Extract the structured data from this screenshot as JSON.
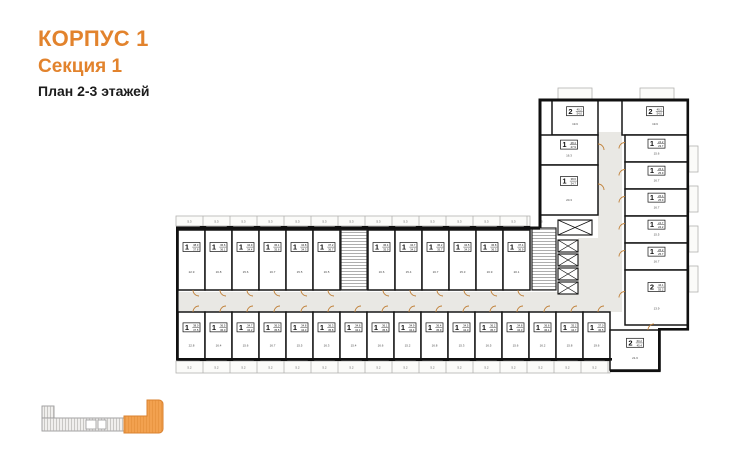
{
  "title": {
    "building": "КОРПУС 1",
    "section": "Секция 1",
    "floors": "План 2-3 этажей"
  },
  "colors": {
    "accent_orange": "#E2832D",
    "wall": "#101010",
    "corridor": "#E9E8E4",
    "door_arc": "#C08038",
    "balcony_outline": "#b3b2b0",
    "locator_fill": "#F2A14F",
    "locator_stroke": "#D9812F"
  },
  "plan": {
    "strips": [
      {
        "x": 176,
        "y": 216,
        "w": 354,
        "h": 10,
        "step": 27,
        "label": "5.3",
        "pier_y": 226
      },
      {
        "x": 176,
        "y": 361,
        "w": 434,
        "h": 12,
        "step": 27,
        "label": "5.2",
        "pier_y": 355
      }
    ],
    "units": [
      {
        "x": 178,
        "y": 230,
        "w": 27,
        "h": 60,
        "t": "1",
        "a1": "38.3",
        "a2": "37.8",
        "r": "22.9",
        "d": "b"
      },
      {
        "x": 205,
        "y": 230,
        "w": 27,
        "h": 60,
        "t": "1",
        "a1": "36.6",
        "a2": "36.1",
        "r": "16.8",
        "d": "b"
      },
      {
        "x": 232,
        "y": 230,
        "w": 27,
        "h": 60,
        "t": "1",
        "a1": "34.9",
        "a2": "34.4",
        "r": "15.6",
        "d": "b"
      },
      {
        "x": 259,
        "y": 230,
        "w": 27,
        "h": 60,
        "t": "1",
        "a1": "36.1",
        "a2": "35.6",
        "r": "16.7",
        "d": "b"
      },
      {
        "x": 286,
        "y": 230,
        "w": 27,
        "h": 60,
        "t": "1",
        "a1": "34.8",
        "a2": "34.3",
        "r": "15.5",
        "d": "b"
      },
      {
        "x": 313,
        "y": 230,
        "w": 27,
        "h": 60,
        "t": "1",
        "a1": "37.2",
        "a2": "36.7",
        "r": "16.5",
        "d": "b"
      },
      {
        "x": 368,
        "y": 230,
        "w": 27,
        "h": 60,
        "t": "1",
        "a1": "36.4",
        "a2": "35.9",
        "r": "16.6",
        "d": "b"
      },
      {
        "x": 395,
        "y": 230,
        "w": 27,
        "h": 60,
        "t": "1",
        "a1": "34.7",
        "a2": "34.2",
        "r": "15.4",
        "d": "b"
      },
      {
        "x": 422,
        "y": 230,
        "w": 27,
        "h": 60,
        "t": "1",
        "a1": "36.2",
        "a2": "35.7",
        "r": "16.7",
        "d": "b"
      },
      {
        "x": 449,
        "y": 230,
        "w": 27,
        "h": 60,
        "t": "1",
        "a1": "34.5",
        "a2": "34.0",
        "r": "15.3",
        "d": "b"
      },
      {
        "x": 476,
        "y": 230,
        "w": 27,
        "h": 60,
        "t": "1",
        "a1": "36.8",
        "a2": "36.3",
        "r": "16.9",
        "d": "b"
      },
      {
        "x": 503,
        "y": 230,
        "w": 27,
        "h": 60,
        "t": "1",
        "a1": "37.4",
        "a2": "36.9",
        "r": "20.1",
        "d": "b"
      },
      {
        "x": 178,
        "y": 312,
        "w": 27,
        "h": 48,
        "t": "1",
        "a1": "38.0",
        "a2": "37.5",
        "r": "22.8",
        "d": "t"
      },
      {
        "x": 205,
        "y": 312,
        "w": 27,
        "h": 48,
        "t": "1",
        "a1": "36.5",
        "a2": "36.0",
        "r": "16.4",
        "d": "t"
      },
      {
        "x": 232,
        "y": 312,
        "w": 27,
        "h": 48,
        "t": "1",
        "a1": "34.7",
        "a2": "34.2",
        "r": "15.6",
        "d": "t"
      },
      {
        "x": 259,
        "y": 312,
        "w": 27,
        "h": 48,
        "t": "1",
        "a1": "36.0",
        "a2": "35.5",
        "r": "16.7",
        "d": "t"
      },
      {
        "x": 286,
        "y": 312,
        "w": 27,
        "h": 48,
        "t": "1",
        "a1": "34.8",
        "a2": "34.3",
        "r": "15.5",
        "d": "t"
      },
      {
        "x": 313,
        "y": 312,
        "w": 27,
        "h": 48,
        "t": "1",
        "a1": "36.3",
        "a2": "35.8",
        "r": "16.3",
        "d": "t"
      },
      {
        "x": 340,
        "y": 312,
        "w": 27,
        "h": 48,
        "t": "1",
        "a1": "34.6",
        "a2": "34.1",
        "r": "15.4",
        "d": "t"
      },
      {
        "x": 367,
        "y": 312,
        "w": 27,
        "h": 48,
        "t": "1",
        "a1": "36.1",
        "a2": "35.6",
        "r": "16.6",
        "d": "t"
      },
      {
        "x": 394,
        "y": 312,
        "w": 27,
        "h": 48,
        "t": "1",
        "a1": "34.9",
        "a2": "34.4",
        "r": "15.2",
        "d": "t"
      },
      {
        "x": 421,
        "y": 312,
        "w": 27,
        "h": 48,
        "t": "1",
        "a1": "36.4",
        "a2": "35.9",
        "r": "16.8",
        "d": "t"
      },
      {
        "x": 448,
        "y": 312,
        "w": 27,
        "h": 48,
        "t": "1",
        "a1": "34.5",
        "a2": "34.0",
        "r": "15.3",
        "d": "t"
      },
      {
        "x": 475,
        "y": 312,
        "w": 27,
        "h": 48,
        "t": "1",
        "a1": "36.2",
        "a2": "35.7",
        "r": "16.5",
        "d": "t"
      },
      {
        "x": 502,
        "y": 312,
        "w": 27,
        "h": 48,
        "t": "1",
        "a1": "34.8",
        "a2": "34.3",
        "r": "15.6",
        "d": "t"
      },
      {
        "x": 529,
        "y": 312,
        "w": 27,
        "h": 48,
        "t": "1",
        "a1": "36.6",
        "a2": "36.1",
        "r": "16.2",
        "d": "t"
      },
      {
        "x": 556,
        "y": 312,
        "w": 27,
        "h": 48,
        "t": "1",
        "a1": "35.2",
        "a2": "34.7",
        "r": "15.8",
        "d": "t"
      },
      {
        "x": 583,
        "y": 312,
        "w": 27,
        "h": 48,
        "t": "1",
        "a1": "37.0",
        "a2": "36.5",
        "r": "19.6",
        "d": "t"
      },
      {
        "x": 552,
        "y": 100,
        "w": 46,
        "h": 35,
        "t": "2",
        "a1": "40.2",
        "a2": "54.0",
        "r": "19.6",
        "d": "b"
      },
      {
        "x": 622,
        "y": 100,
        "w": 66,
        "h": 35,
        "t": "2",
        "a1": "40.2",
        "a2": "54.0",
        "r": "19.6",
        "d": "b"
      },
      {
        "x": 540,
        "y": 135,
        "w": 58,
        "h": 30,
        "t": "1",
        "a1": "28.4",
        "a2": "27.9",
        "r": "16.3",
        "d": "r"
      },
      {
        "x": 540,
        "y": 165,
        "w": 58,
        "h": 50,
        "t": "1",
        "a1": "38.6",
        "a2": "34.7",
        "r": "20.3",
        "d": "r"
      },
      {
        "x": 625,
        "y": 135,
        "w": 63,
        "h": 27,
        "t": "1",
        "a1": "24.2",
        "a2": "23.7",
        "r": "15.6",
        "d": "l"
      },
      {
        "x": 625,
        "y": 162,
        "w": 63,
        "h": 27,
        "t": "1",
        "a1": "26.4",
        "a2": "25.9",
        "r": "16.7",
        "d": "l"
      },
      {
        "x": 625,
        "y": 189,
        "w": 63,
        "h": 27,
        "t": "1",
        "a1": "26.4",
        "a2": "25.9",
        "r": "16.7",
        "d": "l"
      },
      {
        "x": 625,
        "y": 216,
        "w": 63,
        "h": 27,
        "t": "1",
        "a1": "24.7",
        "a2": "24.2",
        "r": "15.5",
        "d": "l"
      },
      {
        "x": 625,
        "y": 243,
        "w": 63,
        "h": 27,
        "t": "1",
        "a1": "26.2",
        "a2": "25.7",
        "r": "16.7",
        "d": "l"
      },
      {
        "x": 625,
        "y": 270,
        "w": 63,
        "h": 55,
        "t": "2",
        "a1": "44.1",
        "a2": "55.2",
        "r": "13.9",
        "d": "l"
      },
      {
        "x": 610,
        "y": 330,
        "w": 50,
        "h": 40,
        "t": "2",
        "a1": "60.2",
        "a2": "45.4",
        "r": "21.6",
        "d": "t"
      }
    ]
  },
  "locator": {
    "note": "section-1-highlight"
  }
}
